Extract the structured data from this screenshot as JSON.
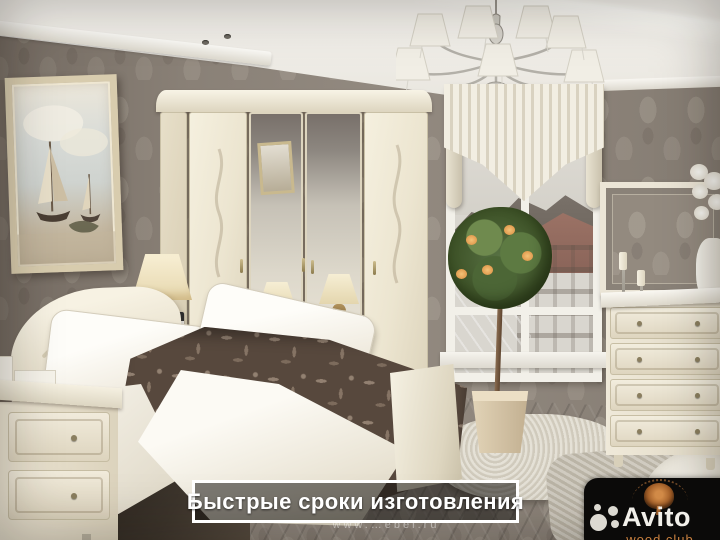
{
  "overlay": {
    "banner": {
      "label": "Быстрые сроки изготовления",
      "text_color": "#ffffff",
      "border_color": "#ffffff",
      "bg_color": "rgba(16,13,11,0.52)"
    },
    "watermark": {
      "text": "www.…ebel.ru"
    },
    "avito_badge": {
      "brand": "Avito",
      "subtitle": "wood club",
      "bg_color": "#0b0a09",
      "brand_color": "#f2f0ea",
      "subtitle_color": "#c9803f",
      "tree_color": "#a35f28"
    }
  },
  "scene": {
    "description": "Classic bedroom: cream wardrobe with mirrored doors, bed with brown floral duvet, seascape painting, chandelier with fabric shades, window with city view, topiary plant, dresser with wall mirror",
    "palette": {
      "wallpaper": "#8e857b",
      "ceiling": "#f6f4ef",
      "furniture_cream": "#efe9d8",
      "duvet_brown": "#57483d",
      "floor_dark": "#2a241f",
      "floor_wood": "#8a7567",
      "rug_light": "#dcd7c9",
      "foliage_green": "#4c6636",
      "flower_orange": "#d98c3f"
    }
  }
}
